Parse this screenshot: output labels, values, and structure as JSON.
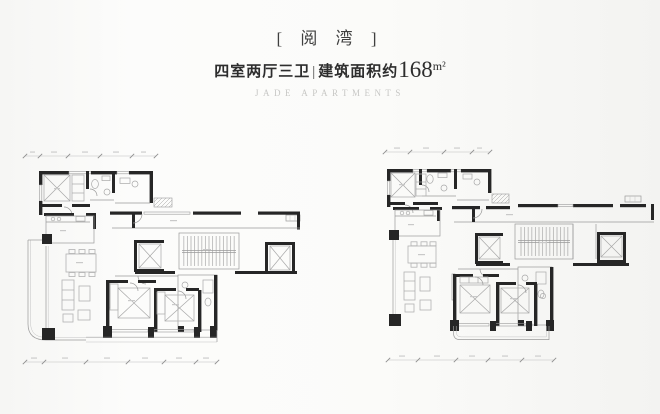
{
  "header": {
    "title": "[ 阅 湾 ]",
    "subtitle": {
      "rooms": "四室两厅三卫",
      "divider": "|",
      "area_label": "建筑面积约",
      "area_value": "168",
      "area_unit": "m²"
    },
    "brand": "JADE APARTMENTS"
  },
  "colors": {
    "background": "#fafaf8",
    "wall": "#262626",
    "thin_line": "#9a9a9a",
    "furniture_line": "#b2b2b2",
    "title_color": "#3f3f3f",
    "subtitle_color": "#2d2d2d",
    "brand_color": "#c7c7c5"
  }
}
